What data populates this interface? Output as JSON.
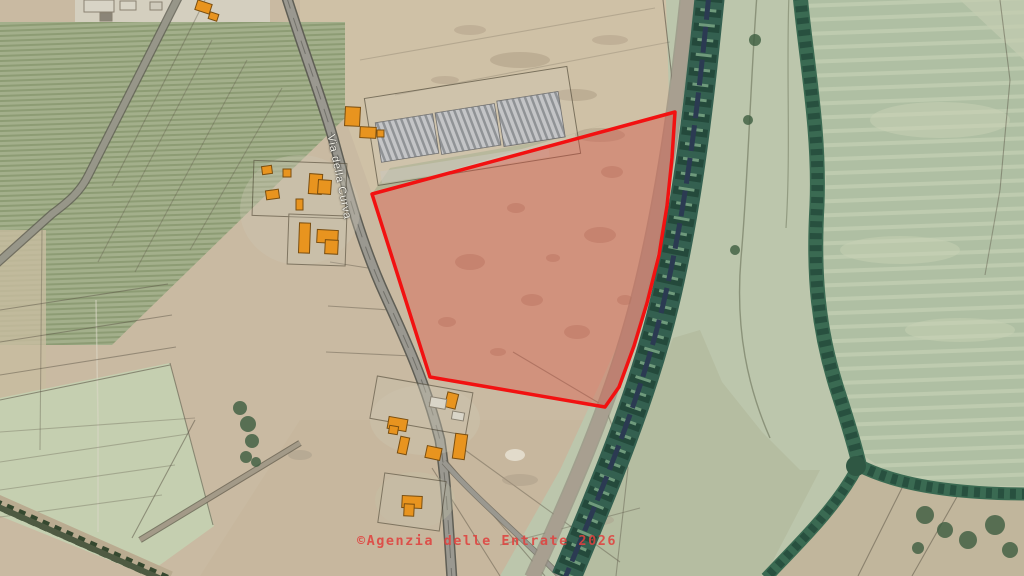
{
  "map": {
    "road_label": "Via della Curva",
    "attribution": "©Agenzia delle Entrate 2026",
    "parcel": {
      "points": "372,194 675,112 672,158 667,206 659,255 647,303 634,346 619,387 605,407 430,377",
      "stroke": "#f21111",
      "fill": "rgba(224,82,66,0.38)"
    },
    "colors": {
      "accent_red": "#f21111",
      "attribution_red": "#e0433f",
      "building_orange": "#e8941f",
      "building_outline": "#7a4e10",
      "field_tan": "#c9baa2",
      "field_sage": "#b2c2a6",
      "canal_green": "#346050",
      "canal_water": "#2b3a52",
      "road_gray": "#9a9890",
      "label_white": "#f2f0e6"
    },
    "buildings": [
      {
        "x": 196,
        "y": 2,
        "w": 15,
        "h": 10,
        "r": 18
      },
      {
        "x": 209,
        "y": 13,
        "w": 9,
        "h": 7,
        "r": 18
      },
      {
        "x": 84,
        "y": 0,
        "w": 30,
        "h": 12,
        "r": 0,
        "f": "#d8d4c6"
      },
      {
        "x": 120,
        "y": 1,
        "w": 16,
        "h": 9,
        "r": 0,
        "f": "#d8d4c6"
      },
      {
        "x": 150,
        "y": 2,
        "w": 12,
        "h": 8,
        "r": 0,
        "f": "#cfcabb"
      },
      {
        "x": 100,
        "y": 13,
        "w": 12,
        "h": 8,
        "r": 0,
        "f": "#8b8578"
      },
      {
        "x": 345,
        "y": 107,
        "w": 15,
        "h": 19,
        "r": 3
      },
      {
        "x": 360,
        "y": 127,
        "w": 16,
        "h": 11,
        "r": 3
      },
      {
        "x": 377,
        "y": 130,
        "w": 7,
        "h": 7,
        "r": 0
      },
      {
        "x": 309,
        "y": 174,
        "w": 13,
        "h": 20,
        "r": 4
      },
      {
        "x": 318,
        "y": 180,
        "w": 13,
        "h": 14,
        "r": 4
      },
      {
        "x": 262,
        "y": 166,
        "w": 10,
        "h": 8,
        "r": -8
      },
      {
        "x": 283,
        "y": 169,
        "w": 8,
        "h": 8,
        "r": 0
      },
      {
        "x": 266,
        "y": 190,
        "w": 13,
        "h": 9,
        "r": -8
      },
      {
        "x": 296,
        "y": 199,
        "w": 7,
        "h": 11,
        "r": 0
      },
      {
        "x": 299,
        "y": 223,
        "w": 11,
        "h": 30,
        "r": 2
      },
      {
        "x": 317,
        "y": 230,
        "w": 21,
        "h": 13,
        "r": 3
      },
      {
        "x": 325,
        "y": 240,
        "w": 13,
        "h": 14,
        "r": 3
      },
      {
        "x": 446,
        "y": 393,
        "w": 11,
        "h": 15,
        "r": 14
      },
      {
        "x": 430,
        "y": 398,
        "w": 16,
        "h": 10,
        "r": 10,
        "f": "#d9d5c8"
      },
      {
        "x": 452,
        "y": 412,
        "w": 12,
        "h": 8,
        "r": 10,
        "f": "#d9d5c8"
      },
      {
        "x": 388,
        "y": 418,
        "w": 19,
        "h": 12,
        "r": 10
      },
      {
        "x": 389,
        "y": 426,
        "w": 9,
        "h": 8,
        "r": 10
      },
      {
        "x": 399,
        "y": 437,
        "w": 9,
        "h": 17,
        "r": 12
      },
      {
        "x": 426,
        "y": 447,
        "w": 15,
        "h": 12,
        "r": 12
      },
      {
        "x": 454,
        "y": 434,
        "w": 12,
        "h": 25,
        "r": 8
      },
      {
        "x": 402,
        "y": 496,
        "w": 20,
        "h": 12,
        "r": 3
      },
      {
        "x": 404,
        "y": 504,
        "w": 10,
        "h": 12,
        "r": 3
      }
    ],
    "boundary_lines": [
      {
        "x1": 205,
        "y1": 0,
        "x2": 112,
        "y2": 186,
        "o": 0.35
      },
      {
        "x1": 212,
        "y1": 40,
        "x2": 98,
        "y2": 262,
        "o": 0.3
      },
      {
        "x1": 247,
        "y1": 60,
        "x2": 135,
        "y2": 272,
        "o": 0.3
      },
      {
        "x1": 282,
        "y1": 88,
        "x2": 190,
        "y2": 250,
        "o": 0.3
      },
      {
        "x1": 0,
        "y1": 310,
        "x2": 168,
        "y2": 284,
        "o": 0.45
      },
      {
        "x1": 0,
        "y1": 342,
        "x2": 172,
        "y2": 315,
        "o": 0.45
      },
      {
        "x1": 0,
        "y1": 375,
        "x2": 176,
        "y2": 347,
        "o": 0.45
      },
      {
        "x1": 0,
        "y1": 400,
        "x2": 170,
        "y2": 365,
        "o": 0.55
      },
      {
        "x1": 0,
        "y1": 432,
        "x2": 195,
        "y2": 418,
        "o": 0.3
      },
      {
        "x1": 0,
        "y1": 462,
        "x2": 188,
        "y2": 434,
        "o": 0.3
      },
      {
        "x1": 0,
        "y1": 490,
        "x2": 175,
        "y2": 465,
        "o": 0.3
      },
      {
        "x1": 0,
        "y1": 517,
        "x2": 162,
        "y2": 495,
        "o": 0.3
      },
      {
        "x1": 170,
        "y1": 363,
        "x2": 213,
        "y2": 525,
        "o": 0.55
      },
      {
        "x1": 195,
        "y1": 420,
        "x2": 132,
        "y2": 538,
        "o": 0.5
      },
      {
        "x1": 42,
        "y1": 230,
        "x2": 40,
        "y2": 450,
        "o": 0.35
      },
      {
        "x1": 330,
        "y1": 262,
        "x2": 368,
        "y2": 268,
        "o": 0.4
      },
      {
        "x1": 328,
        "y1": 306,
        "x2": 390,
        "y2": 310,
        "o": 0.4
      },
      {
        "x1": 326,
        "y1": 352,
        "x2": 412,
        "y2": 356,
        "o": 0.4
      },
      {
        "x1": 360,
        "y1": 60,
        "x2": 655,
        "y2": 8,
        "o": 0.22
      },
      {
        "x1": 395,
        "y1": 95,
        "x2": 670,
        "y2": 42,
        "o": 0.2
      },
      {
        "x1": 663,
        "y1": 0,
        "x2": 671,
        "y2": 70,
        "o": 0.6
      },
      {
        "x1": 671,
        "y1": 70,
        "x2": 675,
        "y2": 112,
        "o": 0.6
      },
      {
        "x1": 513,
        "y1": 352,
        "x2": 604,
        "y2": 406,
        "o": 0.45
      },
      {
        "x1": 604,
        "y1": 406,
        "x2": 634,
        "y2": 318,
        "o": 0.4
      },
      {
        "x1": 605,
        "y1": 407,
        "x2": 628,
        "y2": 468,
        "o": 0.4
      },
      {
        "x1": 628,
        "y1": 468,
        "x2": 616,
        "y2": 576,
        "o": 0.4
      },
      {
        "x1": 432,
        "y1": 468,
        "x2": 500,
        "y2": 576,
        "o": 0.45
      },
      {
        "x1": 448,
        "y1": 462,
        "x2": 545,
        "y2": 576,
        "o": 0.45
      },
      {
        "x1": 465,
        "y1": 450,
        "x2": 620,
        "y2": 562,
        "o": 0.4
      },
      {
        "x1": 500,
        "y1": 545,
        "x2": 640,
        "y2": 508,
        "o": 0.35
      },
      {
        "x1": 1000,
        "y1": 0,
        "x2": 1010,
        "y2": 80,
        "o": 0.45
      },
      {
        "x1": 1010,
        "y1": 80,
        "x2": 1000,
        "y2": 190,
        "o": 0.45
      },
      {
        "x1": 1000,
        "y1": 190,
        "x2": 985,
        "y2": 275,
        "o": 0.4
      },
      {
        "x1": 905,
        "y1": 482,
        "x2": 858,
        "y2": 576,
        "o": 0.5
      },
      {
        "x1": 958,
        "y1": 495,
        "x2": 912,
        "y2": 576,
        "o": 0.5
      }
    ],
    "tree_clusters": [
      {
        "cx": 240,
        "cy": 408,
        "r": 7
      },
      {
        "cx": 248,
        "cy": 424,
        "r": 8
      },
      {
        "cx": 252,
        "cy": 441,
        "r": 7
      },
      {
        "cx": 246,
        "cy": 457,
        "r": 6
      },
      {
        "cx": 256,
        "cy": 462,
        "r": 5
      },
      {
        "cx": 925,
        "cy": 515,
        "r": 9
      },
      {
        "cx": 945,
        "cy": 530,
        "r": 8
      },
      {
        "cx": 968,
        "cy": 540,
        "r": 9
      },
      {
        "cx": 995,
        "cy": 525,
        "r": 10
      },
      {
        "cx": 1010,
        "cy": 550,
        "r": 8
      },
      {
        "cx": 918,
        "cy": 548,
        "r": 6
      },
      {
        "cx": 755,
        "cy": 40,
        "r": 6
      },
      {
        "cx": 748,
        "cy": 120,
        "r": 5
      },
      {
        "cx": 735,
        "cy": 250,
        "r": 5
      }
    ],
    "soil_marks": [
      {
        "cx": 470,
        "cy": 262,
        "rx": 15,
        "ry": 8
      },
      {
        "cx": 532,
        "cy": 300,
        "rx": 11,
        "ry": 6
      },
      {
        "cx": 600,
        "cy": 235,
        "rx": 16,
        "ry": 8
      },
      {
        "cx": 516,
        "cy": 208,
        "rx": 9,
        "ry": 5
      },
      {
        "cx": 577,
        "cy": 332,
        "rx": 13,
        "ry": 7
      },
      {
        "cx": 447,
        "cy": 322,
        "rx": 9,
        "ry": 5
      },
      {
        "cx": 612,
        "cy": 172,
        "rx": 11,
        "ry": 6
      },
      {
        "cx": 498,
        "cy": 352,
        "rx": 8,
        "ry": 4
      },
      {
        "cx": 553,
        "cy": 258,
        "rx": 7,
        "ry": 4
      },
      {
        "cx": 625,
        "cy": 300,
        "rx": 8,
        "ry": 5
      },
      {
        "cx": 520,
        "cy": 60,
        "rx": 30,
        "ry": 8,
        "f": "#a3917a",
        "o": 0.4
      },
      {
        "cx": 575,
        "cy": 95,
        "rx": 22,
        "ry": 6,
        "f": "#a3917a",
        "o": 0.4
      },
      {
        "cx": 610,
        "cy": 40,
        "rx": 18,
        "ry": 5,
        "f": "#a3917a",
        "o": 0.35
      },
      {
        "cx": 470,
        "cy": 30,
        "rx": 16,
        "ry": 5,
        "f": "#a3917a",
        "o": 0.35
      },
      {
        "cx": 445,
        "cy": 80,
        "rx": 14,
        "ry": 4,
        "f": "#a3917a",
        "o": 0.35
      },
      {
        "cx": 600,
        "cy": 135,
        "rx": 25,
        "ry": 7,
        "f": "#a3917a",
        "o": 0.4
      },
      {
        "cx": 520,
        "cy": 480,
        "rx": 18,
        "ry": 6,
        "f": "#a59683",
        "o": 0.4
      },
      {
        "cx": 600,
        "cy": 520,
        "rx": 14,
        "ry": 5,
        "f": "#a59683",
        "o": 0.35
      },
      {
        "cx": 300,
        "cy": 455,
        "rx": 12,
        "ry": 5,
        "f": "#9a9181",
        "o": 0.35
      },
      {
        "cx": 515,
        "cy": 455,
        "rx": 10,
        "ry": 6,
        "f": "#e8e3d6",
        "o": 0.8
      }
    ]
  }
}
